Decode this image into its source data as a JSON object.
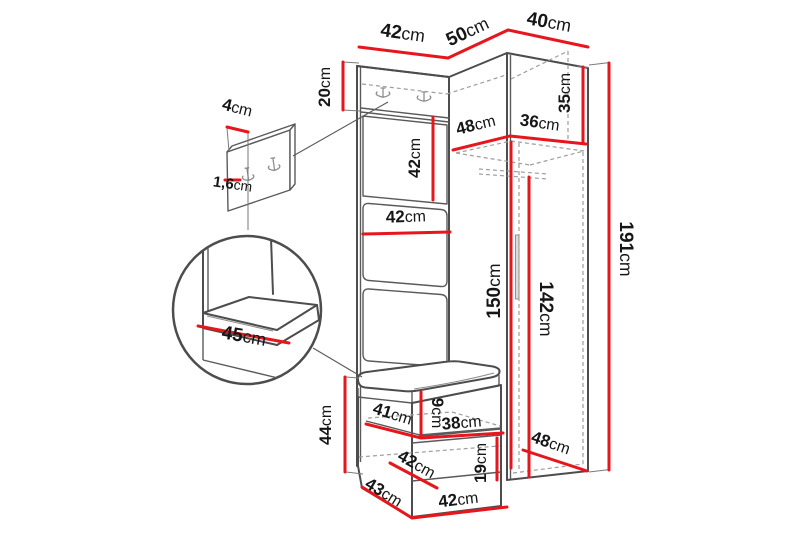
{
  "diagram": {
    "type": "furniture-dimension-diagram",
    "subject": "corner hallway wardrobe set with hook panel, mirror, cushions, shoe bench and tall cabinet",
    "unit_system": "cm",
    "colors": {
      "dimension_line": "#e8151c",
      "outline": "#4d4d4d",
      "hidden_line": "#9e9e9e",
      "text": "#161616",
      "background": "#ffffff"
    },
    "icons": {
      "coat_hook": "double-coat-hook",
      "magnifier_detail": "zoom-circle"
    }
  },
  "measurements": {
    "top_panel_width": {
      "value": "42",
      "unit": "cm"
    },
    "top_corner_width": {
      "value": "50",
      "unit": "cm"
    },
    "top_wardrobe_width": {
      "value": "40",
      "unit": "cm"
    },
    "hook_panel_height": {
      "value": "20",
      "unit": "cm"
    },
    "hook_strip_width": {
      "value": "4",
      "unit": "cm"
    },
    "hook_strip_thickness": {
      "value": "1,6",
      "unit": "cm"
    },
    "mirror_panel_height": {
      "value": "42",
      "unit": "cm"
    },
    "panel_width_middle": {
      "value": "42",
      "unit": "cm"
    },
    "wardrobe_top_compartment_height": {
      "value": "35",
      "unit": "cm"
    },
    "wardrobe_interior_depth": {
      "value": "48",
      "unit": "cm"
    },
    "wardrobe_interior_width": {
      "value": "36",
      "unit": "cm"
    },
    "wardrobe_interior_height_front": {
      "value": "150",
      "unit": "cm"
    },
    "wardrobe_interior_height_back": {
      "value": "142",
      "unit": "cm"
    },
    "wardrobe_total_height": {
      "value": "191",
      "unit": "cm"
    },
    "bench_height": {
      "value": "44",
      "unit": "cm"
    },
    "seat_cushion_depth": {
      "value": "45",
      "unit": "cm"
    },
    "seat_cushion_thickness": {
      "value": "9",
      "unit": "cm"
    },
    "bench_shelf_depth": {
      "value": "41",
      "unit": "cm"
    },
    "bench_shelf_width": {
      "value": "38",
      "unit": "cm"
    },
    "bench_middle_depth": {
      "value": "42",
      "unit": "cm"
    },
    "bench_lower_compartment_height": {
      "value": "19",
      "unit": "cm"
    },
    "bench_base_depth": {
      "value": "43",
      "unit": "cm"
    },
    "bench_base_width": {
      "value": "42",
      "unit": "cm"
    },
    "wardrobe_base_depth": {
      "value": "48",
      "unit": "cm"
    }
  }
}
